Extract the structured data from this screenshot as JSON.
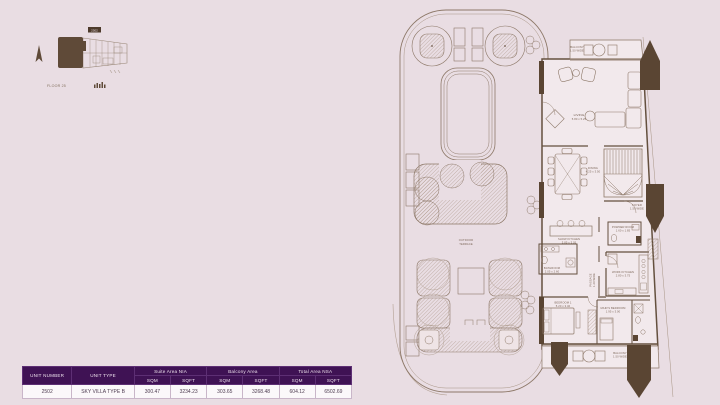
{
  "page": {
    "background": "#e9dde3"
  },
  "colors": {
    "table_header_bg": "#3f1254",
    "table_row_bg": "#fbf8fa",
    "plan_line": "#8d7868",
    "plan_wall": "#64503e",
    "plan_column_fill": "#5a4533",
    "label_text": "#6e584a"
  },
  "key_plan": {
    "unit_chip": "2502",
    "floor_label": "FLOOR 25"
  },
  "floor_plan": {
    "terrace_label_line1": "OUTDOOR",
    "terrace_label_line2": "TERRACE",
    "rooms": {
      "balcony_top": {
        "name": "BALCONY",
        "dims": "1.50 WIDE"
      },
      "living": {
        "name": "LIVING",
        "dims": "5.80 x 5.25"
      },
      "dining": {
        "name": "DINING",
        "dims": "4.25 x 3.50"
      },
      "foyer": {
        "name": "FOYER",
        "dims": "1.50 WIDE"
      },
      "show_kitchen": {
        "name": "SHOW KITCHEN",
        "dims": "3.85 x 3.05"
      },
      "powder_room": {
        "name": "POWDER ROOM",
        "dims": "1.60 x 1.85"
      },
      "work_kitchen": {
        "name": "WORK KITCHEN",
        "dims": "2.80 x 3.75"
      },
      "passage": {
        "name": "PASSAGE",
        "dims": "1.20 WIDE"
      },
      "bathroom": {
        "name": "BATHROOM",
        "dims": "2.05 x 2.60"
      },
      "bedroom_1": {
        "name": "BEDROOM 1",
        "dims": "5.20 x 3.40"
      },
      "maids_bedroom": {
        "name": "MAID'S BEDROOM",
        "dims": "1.95 x 3.00"
      },
      "balcony_bottom": {
        "name": "BALCONY",
        "dims": "1.50 WIDE"
      }
    }
  },
  "table": {
    "col_unit_number": "UNIT NUMBER",
    "col_unit_type": "UNIT TYPE",
    "group_suite": "Suite Area NIA",
    "group_balcony": "Balcony Area",
    "group_total": "Total Area NSA",
    "col_sqm": "SQM",
    "col_sqft": "SQFT",
    "row": {
      "unit_number": "2502",
      "unit_type": "SKY VILLA TYPE B",
      "suite_sqm": "300.47",
      "suite_sqft": "3234.23",
      "balcony_sqm": "303.65",
      "balcony_sqft": "3268.48",
      "total_sqm": "604.12",
      "total_sqft": "6502.69"
    }
  }
}
